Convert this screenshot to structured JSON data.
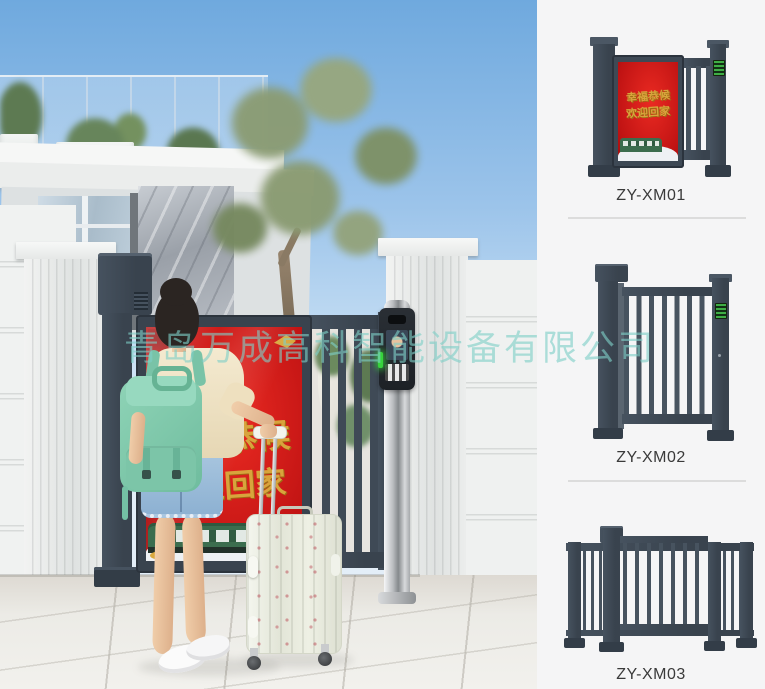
{
  "watermark": {
    "text": "青岛万成高科智能设备有限公司",
    "color": "#7ECEC7"
  },
  "scene": {
    "ad_panel": {
      "line1": "幸福恭候",
      "line2": "欢迎回家",
      "bg_color": "#C81616",
      "text_color": "#D8A43C"
    }
  },
  "products": [
    {
      "model": "ZY-XM01",
      "ad_line1": "幸福恭候",
      "ad_line2": "欢迎回家"
    },
    {
      "model": "ZY-XM02"
    },
    {
      "model": "ZY-XM03"
    }
  ],
  "icons": {
    "access_keypad": "green-keypad-icon",
    "face_screen": "face-recognition-screen",
    "status_light": "green-indicator"
  },
  "colors": {
    "gate_slate": "#3E4955",
    "ad_red": "#C81616",
    "gold": "#D8A43C",
    "mint_backpack": "#82CCB0",
    "divider": "#DCDCDC",
    "label_text": "#3A3A3A",
    "keypad_green": "#2F9E3F",
    "watermark": "#7ECEC7"
  }
}
